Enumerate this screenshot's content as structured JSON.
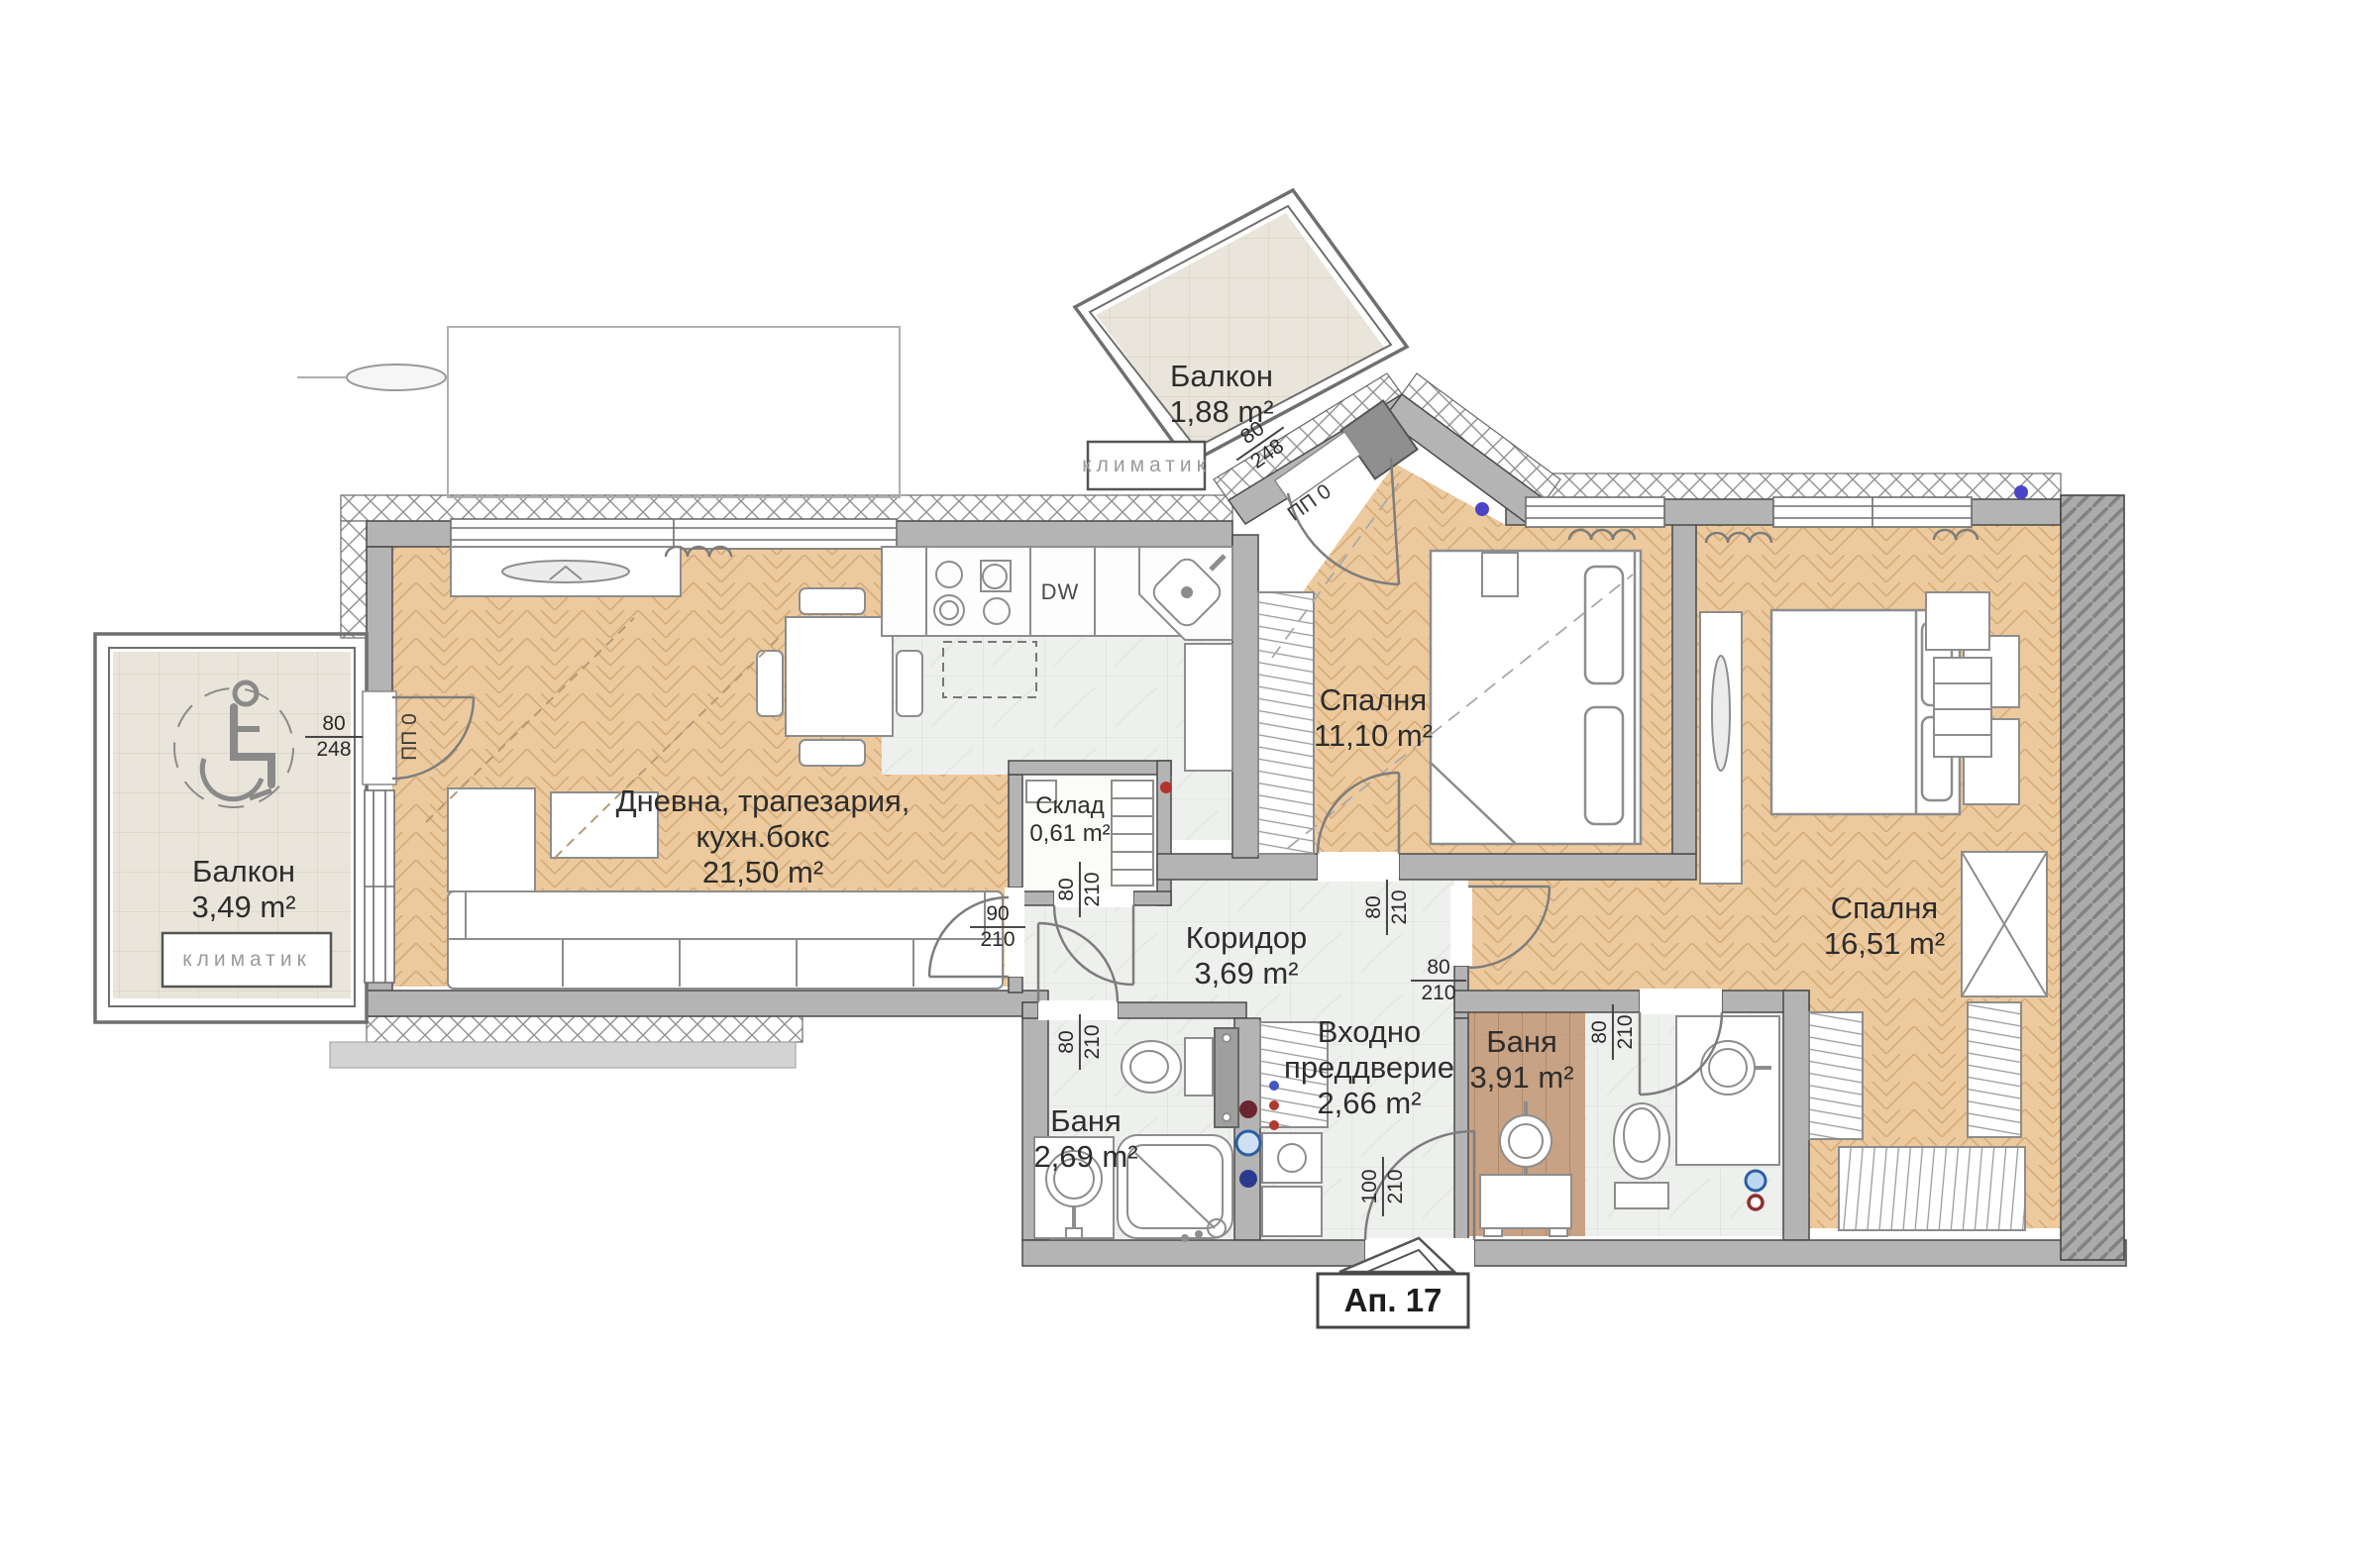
{
  "rooms": {
    "balcony_top": {
      "name": "Балкон",
      "area": "1,88 m²"
    },
    "balcony_left": {
      "name": "Балкон",
      "area": "3,49 m²"
    },
    "living": {
      "line1": "Дневна, трапезария,",
      "line2": "кухн.бокс",
      "area": "21,50 m²"
    },
    "storage": {
      "name": "Склад",
      "area": "0,61 m²"
    },
    "corridor": {
      "name": "Коридор",
      "area": "3,69 m²"
    },
    "entry": {
      "line1": "Входно",
      "line2": "преддверие",
      "area": "2,66 m²"
    },
    "bath1": {
      "name": "Баня",
      "area": "2,69 m²"
    },
    "bath2": {
      "name": "Баня",
      "area": "3,91 m²"
    },
    "bedroom1": {
      "name": "Спалня",
      "area": "11,10 m²"
    },
    "bedroom2": {
      "name": "Спалня",
      "area": "16,51 m²"
    }
  },
  "labels": {
    "klimatik_top": "климатик",
    "klimatik_left": "климатик",
    "dishwasher": "DW",
    "apartment": "Ап. 17"
  },
  "doors": {
    "balcony_left": {
      "w": "80",
      "h": "248",
      "code": "ПП 0"
    },
    "balcony_top": {
      "w": "80",
      "h": "248",
      "code": "ПП 0"
    },
    "living": {
      "w": "90",
      "h": "210"
    },
    "storage": {
      "w": "80",
      "h": "210"
    },
    "bath1": {
      "w": "80",
      "h": "210"
    },
    "bedroom1": {
      "w": "80",
      "h": "210"
    },
    "bedroom2": {
      "w": "80",
      "h": "210"
    },
    "bath2": {
      "w": "80",
      "h": "210"
    },
    "entrance": {
      "w": "100",
      "h": "210"
    }
  },
  "colors": {
    "parquet": "#ecca9e",
    "tile_interior": "#eef0ed",
    "tile_balcony": "#e9e5da",
    "wood": "#c8a284",
    "wall": "#b4b4b4",
    "accent_blue": "#4a44c8",
    "accent_red": "#b3342e"
  }
}
